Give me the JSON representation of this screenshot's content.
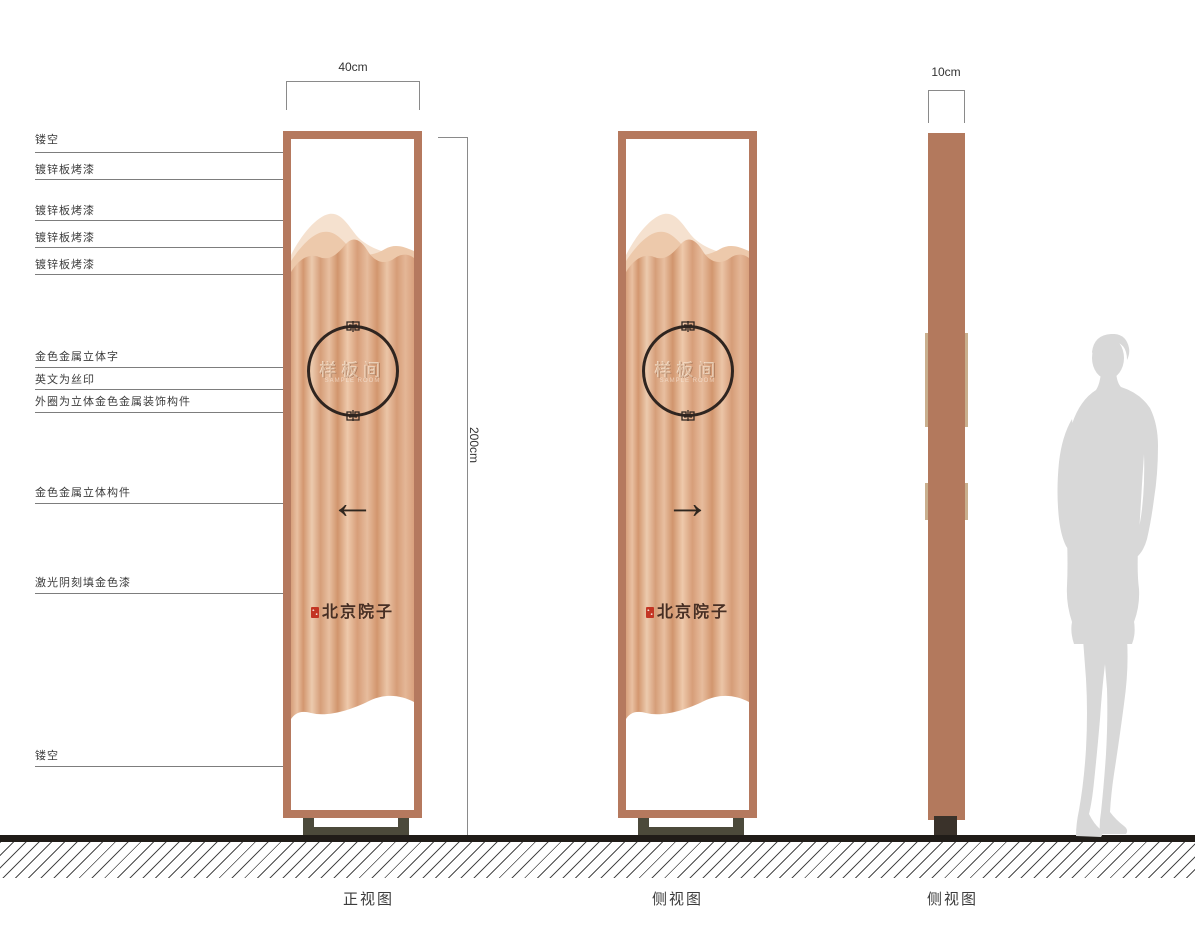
{
  "annotations": [
    {
      "label": "镂空"
    },
    {
      "label": "镀锌板烤漆"
    },
    {
      "label": "镀锌板烤漆"
    },
    {
      "label": "镀锌板烤漆"
    },
    {
      "label": "镀锌板烤漆"
    },
    {
      "label": "金色金属立体字"
    },
    {
      "label": "英文为丝印"
    },
    {
      "label": "外圈为立体金色金属装饰构件"
    },
    {
      "label": "金色金属立体构件"
    },
    {
      "label": "激光阴刻填金色漆"
    },
    {
      "label": "镂空"
    }
  ],
  "dimensions": {
    "front_width": "40cm",
    "height": "200cm",
    "side_depth": "10cm"
  },
  "panels": {
    "front": {
      "caption": "正视图",
      "emblem_text": "样板间",
      "emblem_subtext": "SAMPLE ROOM",
      "arrow": "←",
      "brand": "北京院子"
    },
    "side": {
      "caption": "侧视图",
      "emblem_text": "样板间",
      "emblem_subtext": "SAMPLE ROOM",
      "arrow": "→",
      "brand": "北京院子"
    },
    "profile": {
      "caption": "侧视图"
    }
  },
  "colors": {
    "frame": "#b5795e",
    "copper_light": "#ecc9ab",
    "copper_dark": "#d1956d",
    "mountain_back": "#f5e1cf",
    "mountain_mid": "#edc9ab",
    "accent_dark": "#30271f",
    "seal_red": "#c33524",
    "tab_tan": "#c9af8e",
    "base_olive": "#4c4a3b",
    "silhouette_gray": "#d8d8d8"
  }
}
